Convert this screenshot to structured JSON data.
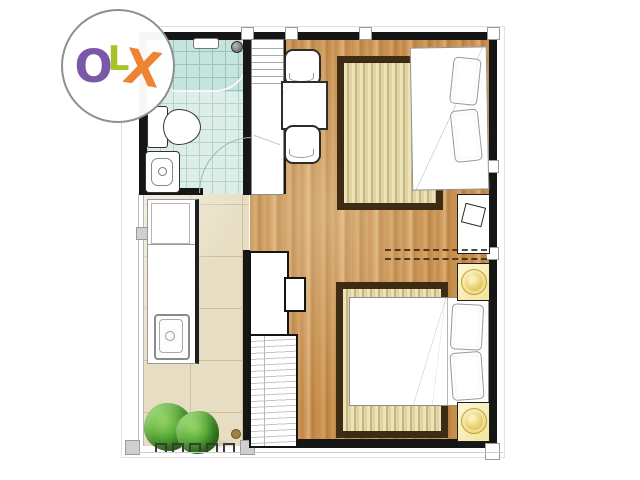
{
  "logo": {
    "text": "OLX",
    "letters": [
      {
        "char": "O",
        "color": "#7b57a8"
      },
      {
        "char": "L",
        "color": "#a6c32c"
      },
      {
        "char": "X",
        "color": "#ee8432"
      }
    ]
  },
  "palette": {
    "wall": "#161616",
    "wood_floor": "#c28a48",
    "bathroom_tile": "#ddeee8",
    "shower_tile": "#c6e4de",
    "balcony_tile": "#e7ddc2",
    "rug_border": "#3d2c13",
    "rug_stripe": "#ded4a4",
    "nightstand": "#f1e49a",
    "lamp_gold": "#e3c44e",
    "plant_green": "#4a9a2c",
    "logo_ring": "#8f8f8f"
  },
  "floorplan": {
    "type": "studio-apartment-floor-plan",
    "rooms": [
      "bathroom",
      "closet",
      "kitchen",
      "balcony",
      "living-sleeping-area"
    ],
    "furniture": [
      "bathtub-shower",
      "toilet",
      "wash-basin",
      "shelf-closet",
      "kitchen-counter",
      "kitchen-sink",
      "dining-table",
      "two-chairs",
      "single-bed",
      "double-bed",
      "two-area-rugs",
      "side-table",
      "two-nightstands-with-lamps",
      "tv-console",
      "wardrobe",
      "balcony-plants"
    ]
  }
}
